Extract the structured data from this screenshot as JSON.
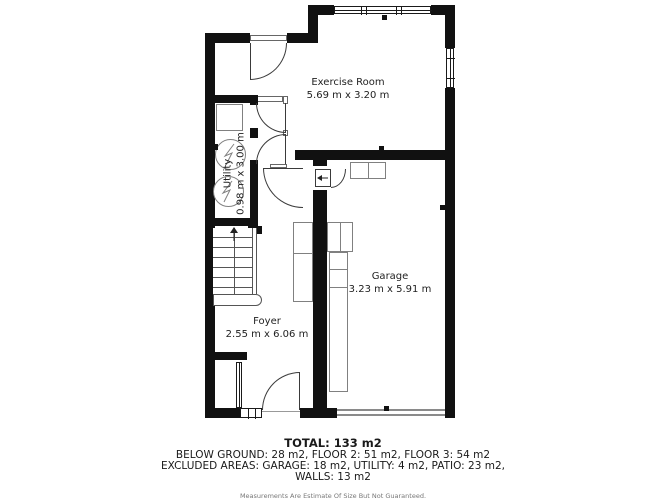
{
  "plan": {
    "rooms": [
      {
        "name": "Exercise Room",
        "dims": "5.69 m x 3.20 m"
      },
      {
        "name": "Garage",
        "dims": "3.23 m x 5.91 m"
      },
      {
        "name": "Foyer",
        "dims": "2.55 m x 6.06 m"
      },
      {
        "name": "Utility",
        "dims": "0.98 m x 3.00 m"
      }
    ],
    "summary": {
      "total": "TOTAL: 133 m2",
      "floors": "BELOW GROUND: 28 m2, FLOOR 2: 51 m2, FLOOR 3: 54 m2",
      "excluded": "EXCLUDED AREAS: GARAGE: 18 m2, UTILITY: 4 m2, PATIO: 23 m2,",
      "excluded2": "WALLS: 13 m2",
      "disclaimer": "Measurements Are Estimate Of Size But Not Guaranteed."
    },
    "colors": {
      "wall": "#111111",
      "outline": "#808080",
      "text": "#222222",
      "muted": "#777777"
    }
  }
}
